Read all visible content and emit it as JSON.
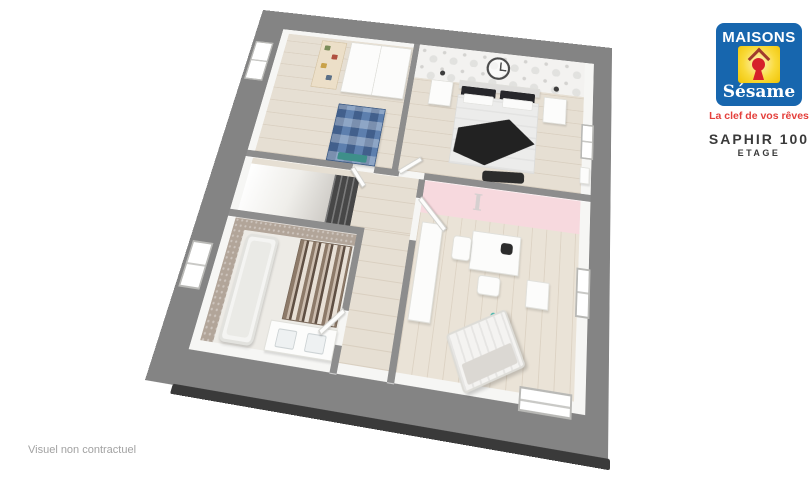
{
  "branding": {
    "logo": {
      "line1": "MAISONS",
      "line2": "Sésame",
      "tagline": "La clef de vos rêves",
      "colors": {
        "blue": "#1766ae",
        "yellow": "#f6c600",
        "keyhole_red": "#d6202a",
        "roof_maroon": "#a03b2d",
        "tagline_red": "#e4403c"
      }
    },
    "model": {
      "name": "SAPHIR 100",
      "level": "ETAGE",
      "text_color": "#3a3a3a"
    }
  },
  "disclaimer": {
    "text": "Visuel non contractuel",
    "color": "#a2a2a2"
  },
  "floorplan": {
    "frame_color": "#848484",
    "wall_cap_color": "#8d8d8d",
    "floor_color": "#e6dfd3",
    "bath_tile_color": "#b2a599",
    "kids_accent_pink": "#f7d9de",
    "blue_bed_color": "#5d7fae",
    "kids_wall_letter": "I",
    "rooms": [
      "bedroom-1",
      "master-bedroom",
      "landing-stairs",
      "bathroom",
      "hallway",
      "kids-bedroom"
    ]
  }
}
